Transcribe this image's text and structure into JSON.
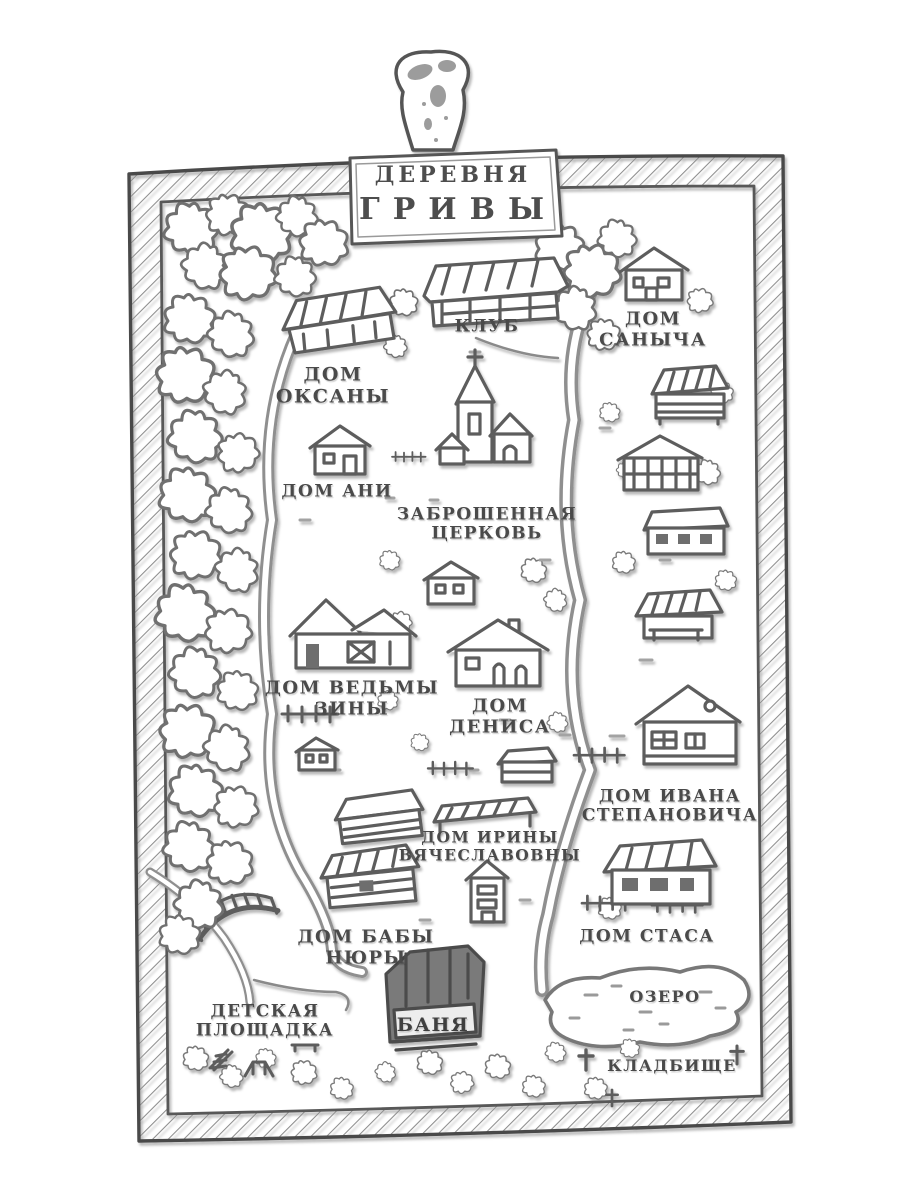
{
  "map": {
    "kind": "hand-drawn village map (book illustration)",
    "title": {
      "line1": "ДЕРЕВНЯ",
      "line2": "ГРИВЫ"
    }
  },
  "labels": {
    "club": {
      "line1": "КЛУБ"
    },
    "sanych": {
      "line1": "ДОМ",
      "line2": "САНЫЧА"
    },
    "oksana": {
      "line1": "ДОМ",
      "line2": "ОКСАНЫ"
    },
    "ani": {
      "line1": "ДОМ АНИ"
    },
    "church": {
      "line1": "ЗАБРОШЕННАЯ",
      "line2": "ЦЕРКОВЬ"
    },
    "zina": {
      "line1": "ДОМ ВЕДЬМЫ",
      "line2": "ЗИНЫ"
    },
    "denis": {
      "line1": "ДОМ",
      "line2": "ДЕНИСА"
    },
    "ivan": {
      "line1": "ДОМ ИВАНА",
      "line2": "СТЕПАНОВИЧА"
    },
    "irina": {
      "line1": "ДОМ ИРИНЫ",
      "line2": "ВЯЧЕСЛАВОВНЫ"
    },
    "nyura": {
      "line1": "ДОМ БАБЫ",
      "line2": "НЮРЫ"
    },
    "stas": {
      "line1": "ДОМ СТАСА"
    },
    "playground": {
      "line1": "ДЕТСКАЯ",
      "line2": "ПЛОЩАДКА"
    },
    "banya": {
      "line1": "БАНЯ"
    },
    "lake": {
      "line1": "ОЗЕРО"
    },
    "cemetery": {
      "line1": "КЛАДБИЩЕ"
    }
  },
  "icons": [
    "binder-clip-icon",
    "signboard",
    "sketch-frame",
    "forest-tree-icon",
    "road",
    "bridge-icon",
    "church-icon",
    "house-icon",
    "barn-icon",
    "bathhouse-icon",
    "lake-shape",
    "grave-cross-icon",
    "fence-icon",
    "playground-marks"
  ],
  "colors": {
    "paper": "#ffffff",
    "ink": "#5d5d5d",
    "shade": "#8f8f8f",
    "label_ink": "#4a4a4a",
    "dark_fill": "#7a7a7a"
  }
}
